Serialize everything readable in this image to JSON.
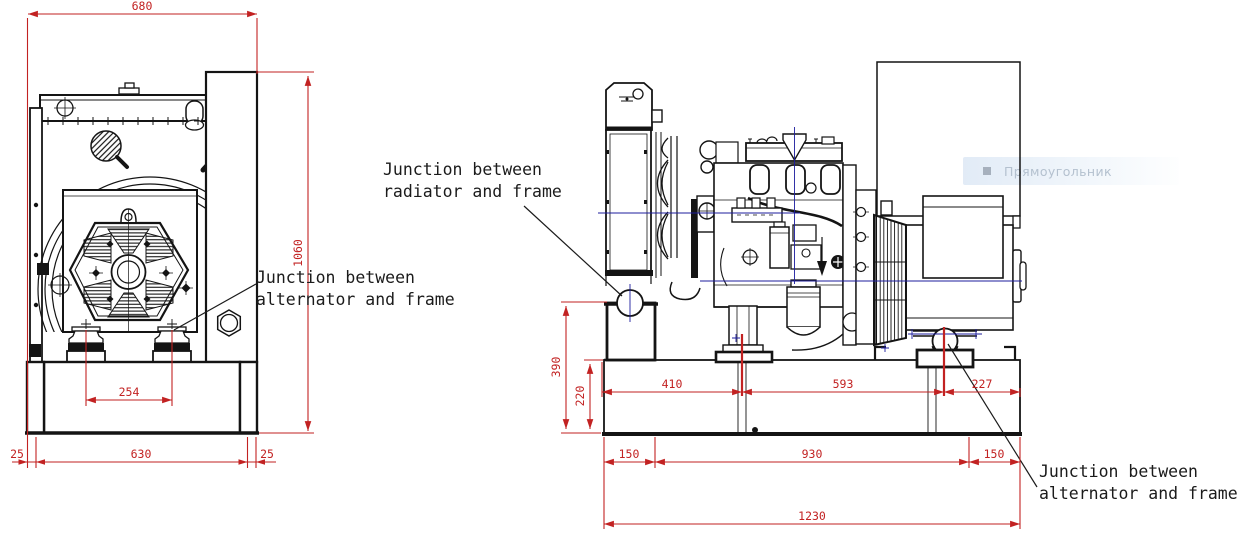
{
  "tooltip": {
    "label": "Прямоугольник"
  },
  "annotations": {
    "radiator_frame": "Junction between\nradiator and frame",
    "alternator_frame_front": "Junction between\nalternator and frame",
    "alternator_frame_side": "Junction between\nalternator and frame"
  },
  "front_view": {
    "dim_overall_width": "680",
    "dim_overall_height": "1060",
    "dim_mount_spacing": "254",
    "dim_left_overhang": "25",
    "dim_frame_width": "630",
    "dim_right_overhang": "25"
  },
  "side_view": {
    "dim_radiator_junction_height": "390",
    "dim_frame_height": "220",
    "dim_frame_to_engine_mount": "410",
    "dim_engine_to_alternator_mount": "593",
    "dim_alternator_mount_to_end": "227",
    "dim_left_overhang": "150",
    "dim_mount_span": "930",
    "dim_right_overhang": "150",
    "dim_overall_length": "1230"
  },
  "colors": {
    "dimension_red": "#c22222",
    "centerline_blue": "#1c1c9e",
    "line_black": "#141414",
    "tooltip_bg": "#e4edf7",
    "tooltip_text": "#b4c1cf"
  }
}
